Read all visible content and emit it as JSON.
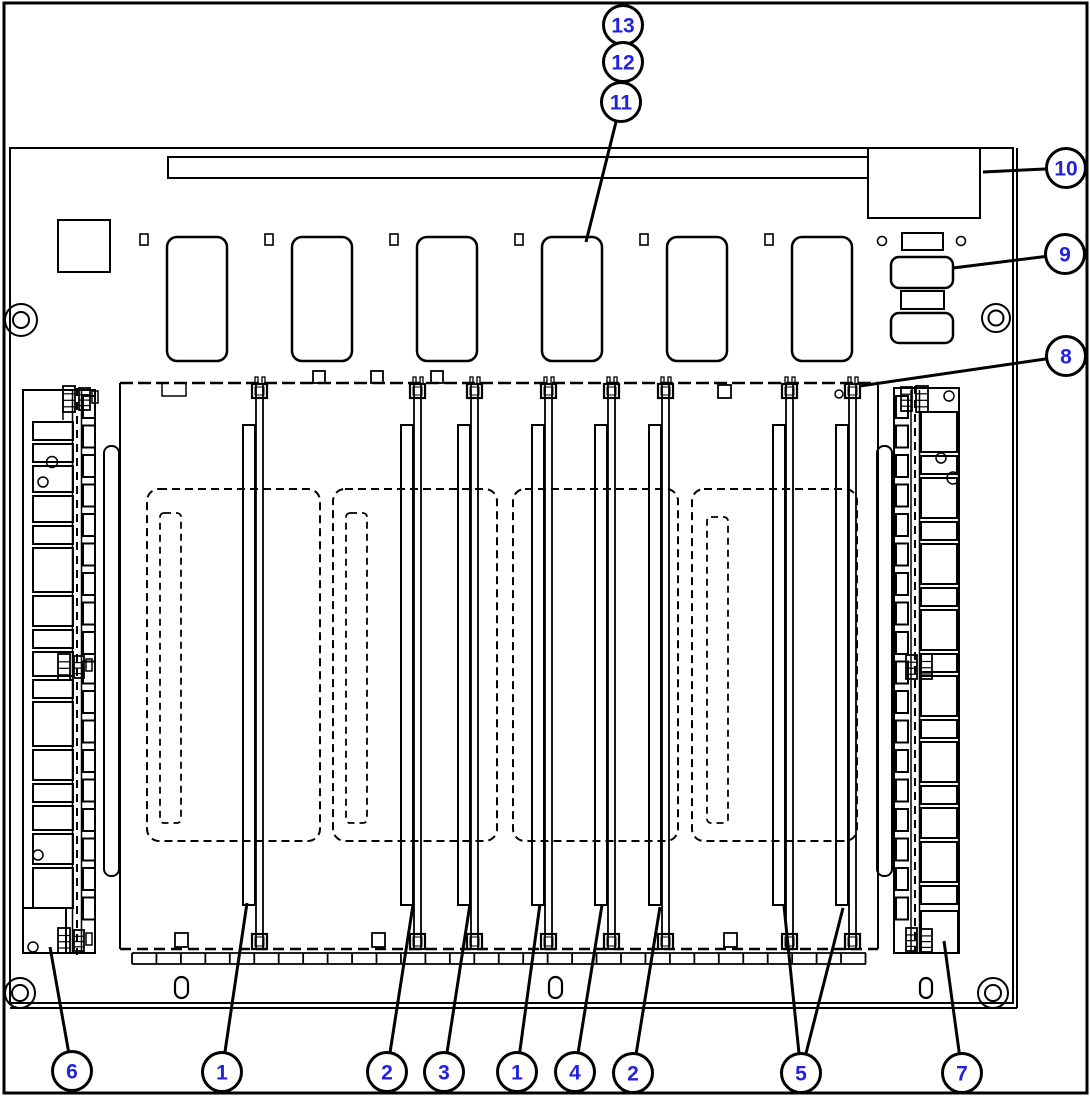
{
  "figure": {
    "type": "technical-parts-line-drawing",
    "background": "#ffffff",
    "line_color": "#000000",
    "panel_slot_count": 6,
    "card_rail_count": 8,
    "callout": {
      "fill": "#ffffff",
      "border_color": "#000000",
      "number_color": "#2222dd",
      "radius": 19.5,
      "font_size": 21
    },
    "callouts": [
      {
        "label": "13",
        "cx": 623,
        "cy": 25,
        "leaders": []
      },
      {
        "label": "12",
        "cx": 623,
        "cy": 62,
        "leaders": []
      },
      {
        "label": "11",
        "cx": 621,
        "cy": 102,
        "leaders": [
          [
            586,
            242
          ]
        ]
      },
      {
        "label": "10",
        "cx": 1066,
        "cy": 168,
        "leaders": [
          [
            983,
            172
          ]
        ]
      },
      {
        "label": "9",
        "cx": 1065,
        "cy": 254,
        "leaders": [
          [
            953,
            268
          ]
        ]
      },
      {
        "label": "8",
        "cx": 1066,
        "cy": 356,
        "leaders": [
          [
            860,
            386
          ]
        ]
      },
      {
        "label": "6",
        "cx": 72,
        "cy": 1071,
        "leaders": [
          [
            50,
            947
          ]
        ]
      },
      {
        "label": "1",
        "cx": 222,
        "cy": 1072,
        "leaders": [
          [
            247,
            903
          ]
        ]
      },
      {
        "label": "2",
        "cx": 387,
        "cy": 1072,
        "leaders": [
          [
            413,
            905
          ]
        ]
      },
      {
        "label": "3",
        "cx": 444,
        "cy": 1072,
        "leaders": [
          [
            470,
            904
          ]
        ]
      },
      {
        "label": "1",
        "cx": 517,
        "cy": 1072,
        "leaders": [
          [
            540,
            904
          ]
        ]
      },
      {
        "label": "4",
        "cx": 575,
        "cy": 1072,
        "leaders": [
          [
            602,
            905
          ]
        ]
      },
      {
        "label": "2",
        "cx": 633,
        "cy": 1073,
        "leaders": [
          [
            660,
            907
          ]
        ]
      },
      {
        "label": "5",
        "cx": 801,
        "cy": 1073,
        "leaders": [
          [
            784,
            906
          ],
          [
            843,
            908
          ]
        ]
      },
      {
        "label": "7",
        "cx": 962,
        "cy": 1073,
        "leaders": [
          [
            944,
            941
          ]
        ]
      }
    ]
  }
}
